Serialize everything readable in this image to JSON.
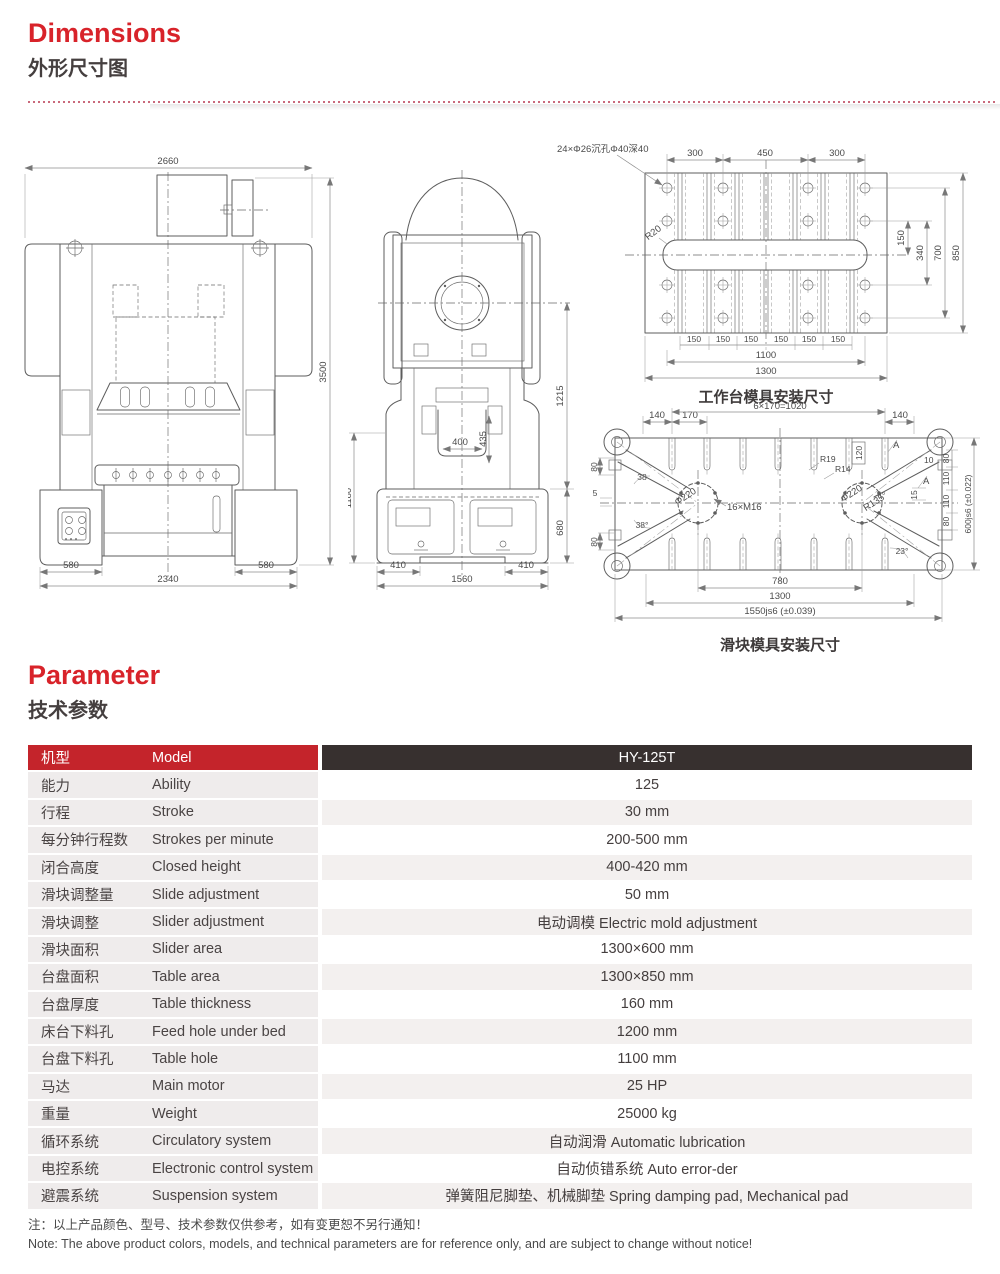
{
  "header": {
    "title": "Dimensions",
    "subtitle": "外形尺寸图"
  },
  "parameter_header": {
    "title": "Parameter",
    "subtitle": "技术参数"
  },
  "drawings": {
    "front": {
      "top_width": "2660",
      "total_height": "3500",
      "foot_left": "580",
      "base_width": "2340",
      "foot_right": "580"
    },
    "side": {
      "flywheel_center_height": "1215",
      "slide_width": "400",
      "slide_depth": "435",
      "lower_height": "1180",
      "base_height": "680",
      "foot_left": "410",
      "base_width": "1560",
      "foot_right": "410"
    },
    "worktable": {
      "callout": "24×Φ26沉孔Φ40深40",
      "radius": "R20",
      "top_dims": [
        "300",
        "450",
        "300"
      ],
      "right_dims": [
        "150",
        "340",
        "700",
        "850"
      ],
      "slot_pitch": [
        "150",
        "150",
        "150",
        "150",
        "150",
        "150"
      ],
      "hole_span": "1100",
      "width": "1300",
      "caption": "工作台模具安装尺寸"
    },
    "slider": {
      "top_dims": [
        "140",
        "170",
        "6×170=1020",
        "140"
      ],
      "left_dims": {
        "d80_top": "80",
        "angle_top": "38",
        "d5": "5",
        "angle_bottom": "38°",
        "d80_bottom": "80"
      },
      "labels": {
        "phi_left": "Φ220",
        "bolts": "16×M16",
        "r19": "R19",
        "r14": "R14",
        "d120": "120",
        "phi_right": "Φ220",
        "r135": "R135°",
        "d10": "10",
        "d15": "15",
        "a23": "23°",
        "section": "A"
      },
      "right_dims": [
        "80",
        "110",
        "110",
        "80"
      ],
      "height": "600js6 (±0.022)",
      "bolt_span": "780",
      "inner_width": "1300",
      "total_width": "1550js6 (±0.039)",
      "caption": "滑块模具安装尺寸"
    }
  },
  "table": {
    "header": {
      "cn": "机型",
      "en": "Model",
      "value": "HY-125T"
    },
    "rows": [
      {
        "cn": "能力",
        "en": "Ability",
        "value": "125"
      },
      {
        "cn": "行程",
        "en": "Stroke",
        "value": "30 mm"
      },
      {
        "cn": "每分钟行程数",
        "en": "Strokes per minute",
        "value": "200-500 mm"
      },
      {
        "cn": "闭合高度",
        "en": "Closed height",
        "value": "400-420 mm"
      },
      {
        "cn": "滑块调整量",
        "en": "Slide adjustment",
        "value": "50 mm"
      },
      {
        "cn": "滑块调整",
        "en": "Slider adjustment",
        "value": "电动调模 Electric mold adjustment"
      },
      {
        "cn": "滑块面积",
        "en": "Slider area",
        "value": "1300×600 mm"
      },
      {
        "cn": "台盘面积",
        "en": "Table area",
        "value": "1300×850 mm"
      },
      {
        "cn": "台盘厚度",
        "en": "Table thickness",
        "value": "160 mm"
      },
      {
        "cn": "床台下料孔",
        "en": "Feed hole under bed",
        "value": "1200 mm"
      },
      {
        "cn": "台盘下料孔",
        "en": "Table hole",
        "value": "1100 mm"
      },
      {
        "cn": "马达",
        "en": "Main motor",
        "value": "25 HP"
      },
      {
        "cn": "重量",
        "en": "Weight",
        "value": "25000 kg"
      },
      {
        "cn": "循环系统",
        "en": "Circulatory system",
        "value": "自动润滑 Automatic lubrication"
      },
      {
        "cn": "电控系统",
        "en": "Electronic control system",
        "value": "自动侦错系统 Auto error-der"
      },
      {
        "cn": "避震系统",
        "en": "Suspension system",
        "value": "弹簧阻尼脚垫、机械脚垫 Spring damping pad, Mechanical pad"
      }
    ]
  },
  "notes": {
    "cn": "注：以上产品颜色、型号、技术参数仅供参考，如有变更恕不另行通知！",
    "en": "Note: The above product colors, models, and technical parameters are for reference only, and are subject to change without notice!"
  },
  "colors": {
    "accent_red": "#d8232a",
    "header_red": "#c4242b",
    "header_dark": "#37302f"
  }
}
